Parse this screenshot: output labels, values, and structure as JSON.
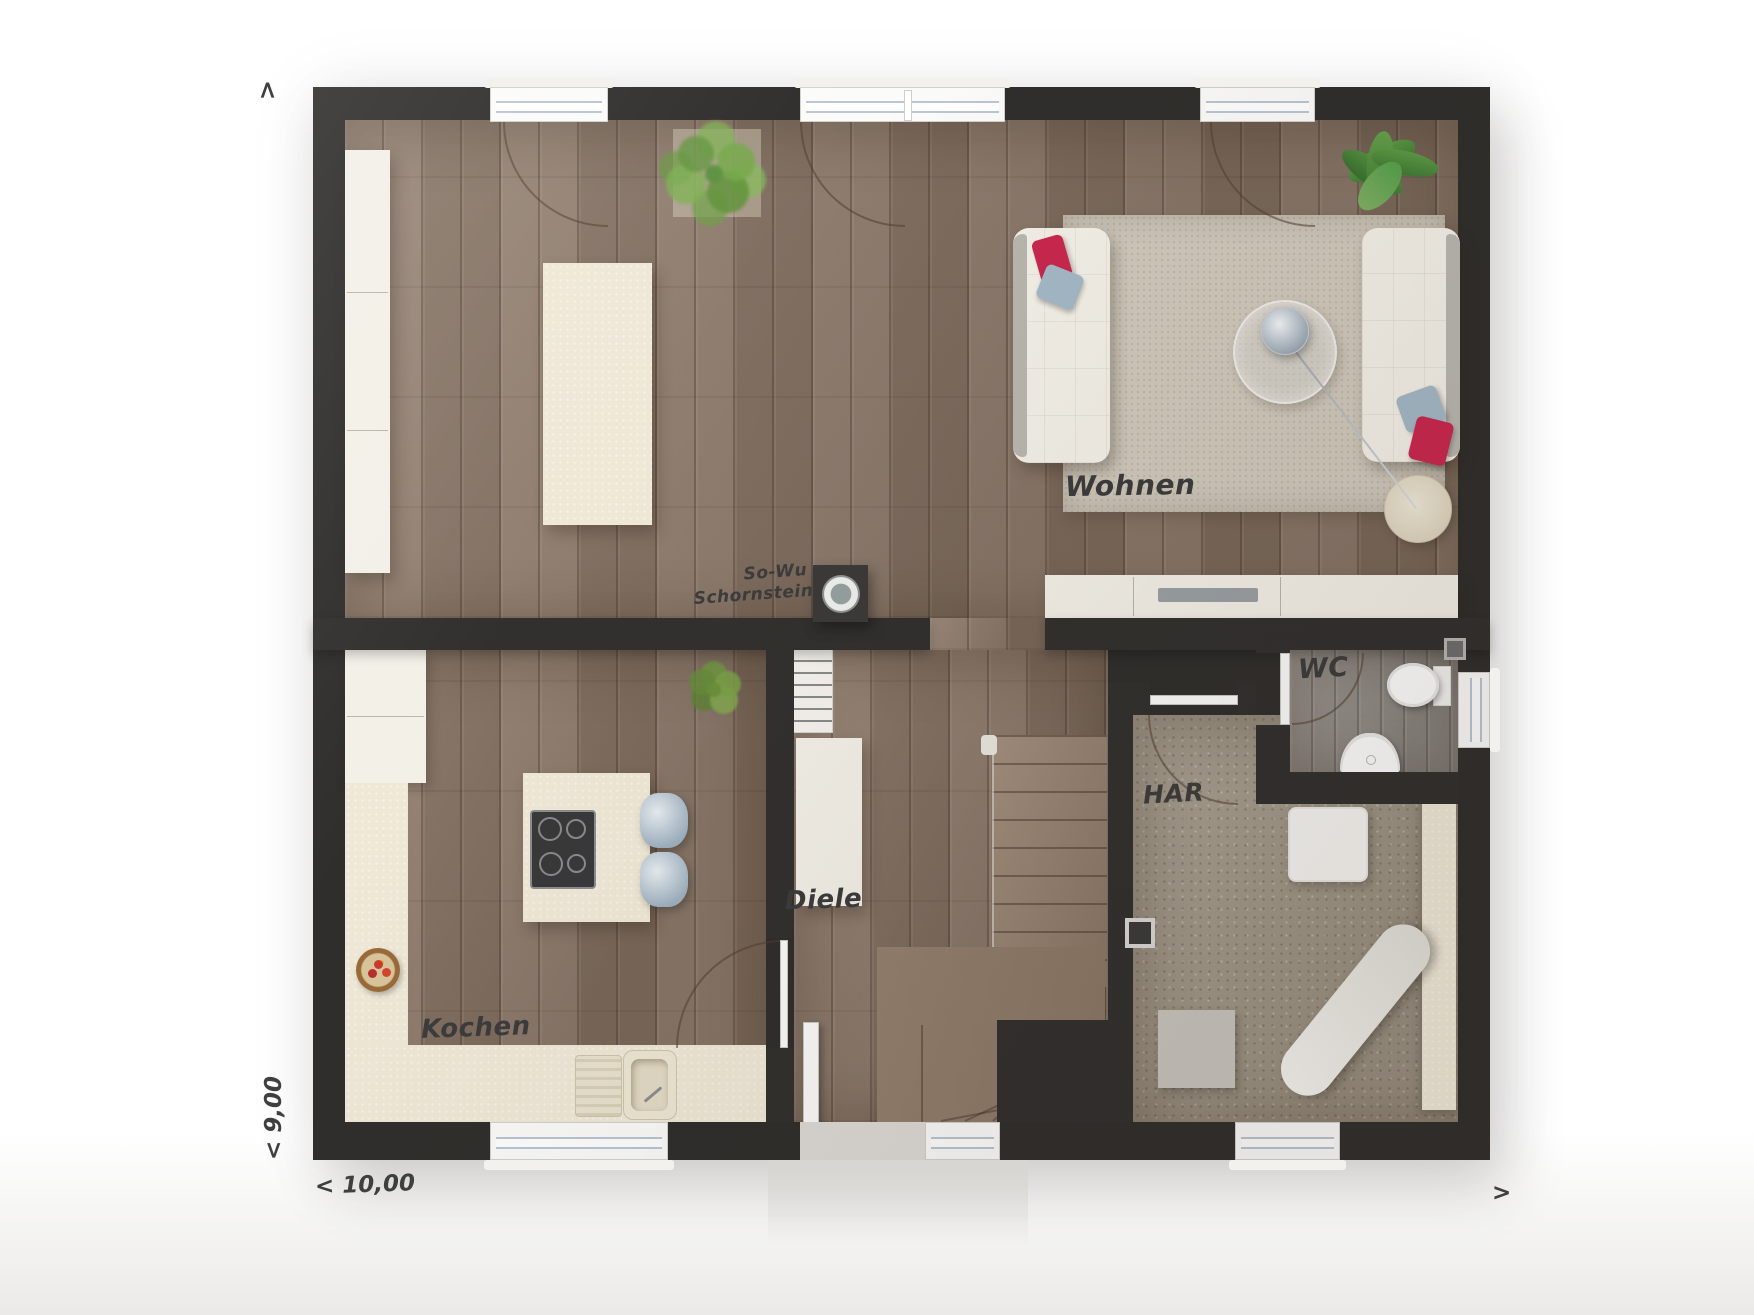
{
  "rooms": {
    "wohnen": {
      "label": "Wohnen"
    },
    "kochen": {
      "label": "Kochen"
    },
    "diele": {
      "label": "Diele"
    },
    "wc": {
      "label": "WC"
    },
    "har": {
      "label": "HAR"
    }
  },
  "chimney": {
    "line1": "So-Wu",
    "line2": "Schornstein"
  },
  "dimensions": {
    "width_label": "< 10,00",
    "height_label": "< 9,00",
    "up_arrow": "<",
    "right_arrow": ">"
  },
  "colors": {
    "wall": "#2f2e2c",
    "wood_floor": "#8d7969",
    "wc_floor": "#9a9590",
    "har_floor": "#a59c8d",
    "counter_cream": "#efe8d7",
    "furniture_white": "#f3f0e8",
    "rug": "#cfc8bb",
    "pillow_red": "#c9274e",
    "pillow_blue": "#a3b8c6",
    "plant_green": "#6fae4e",
    "glass_line": "#b9c6d3",
    "label_ink": "#3c3c3c"
  }
}
